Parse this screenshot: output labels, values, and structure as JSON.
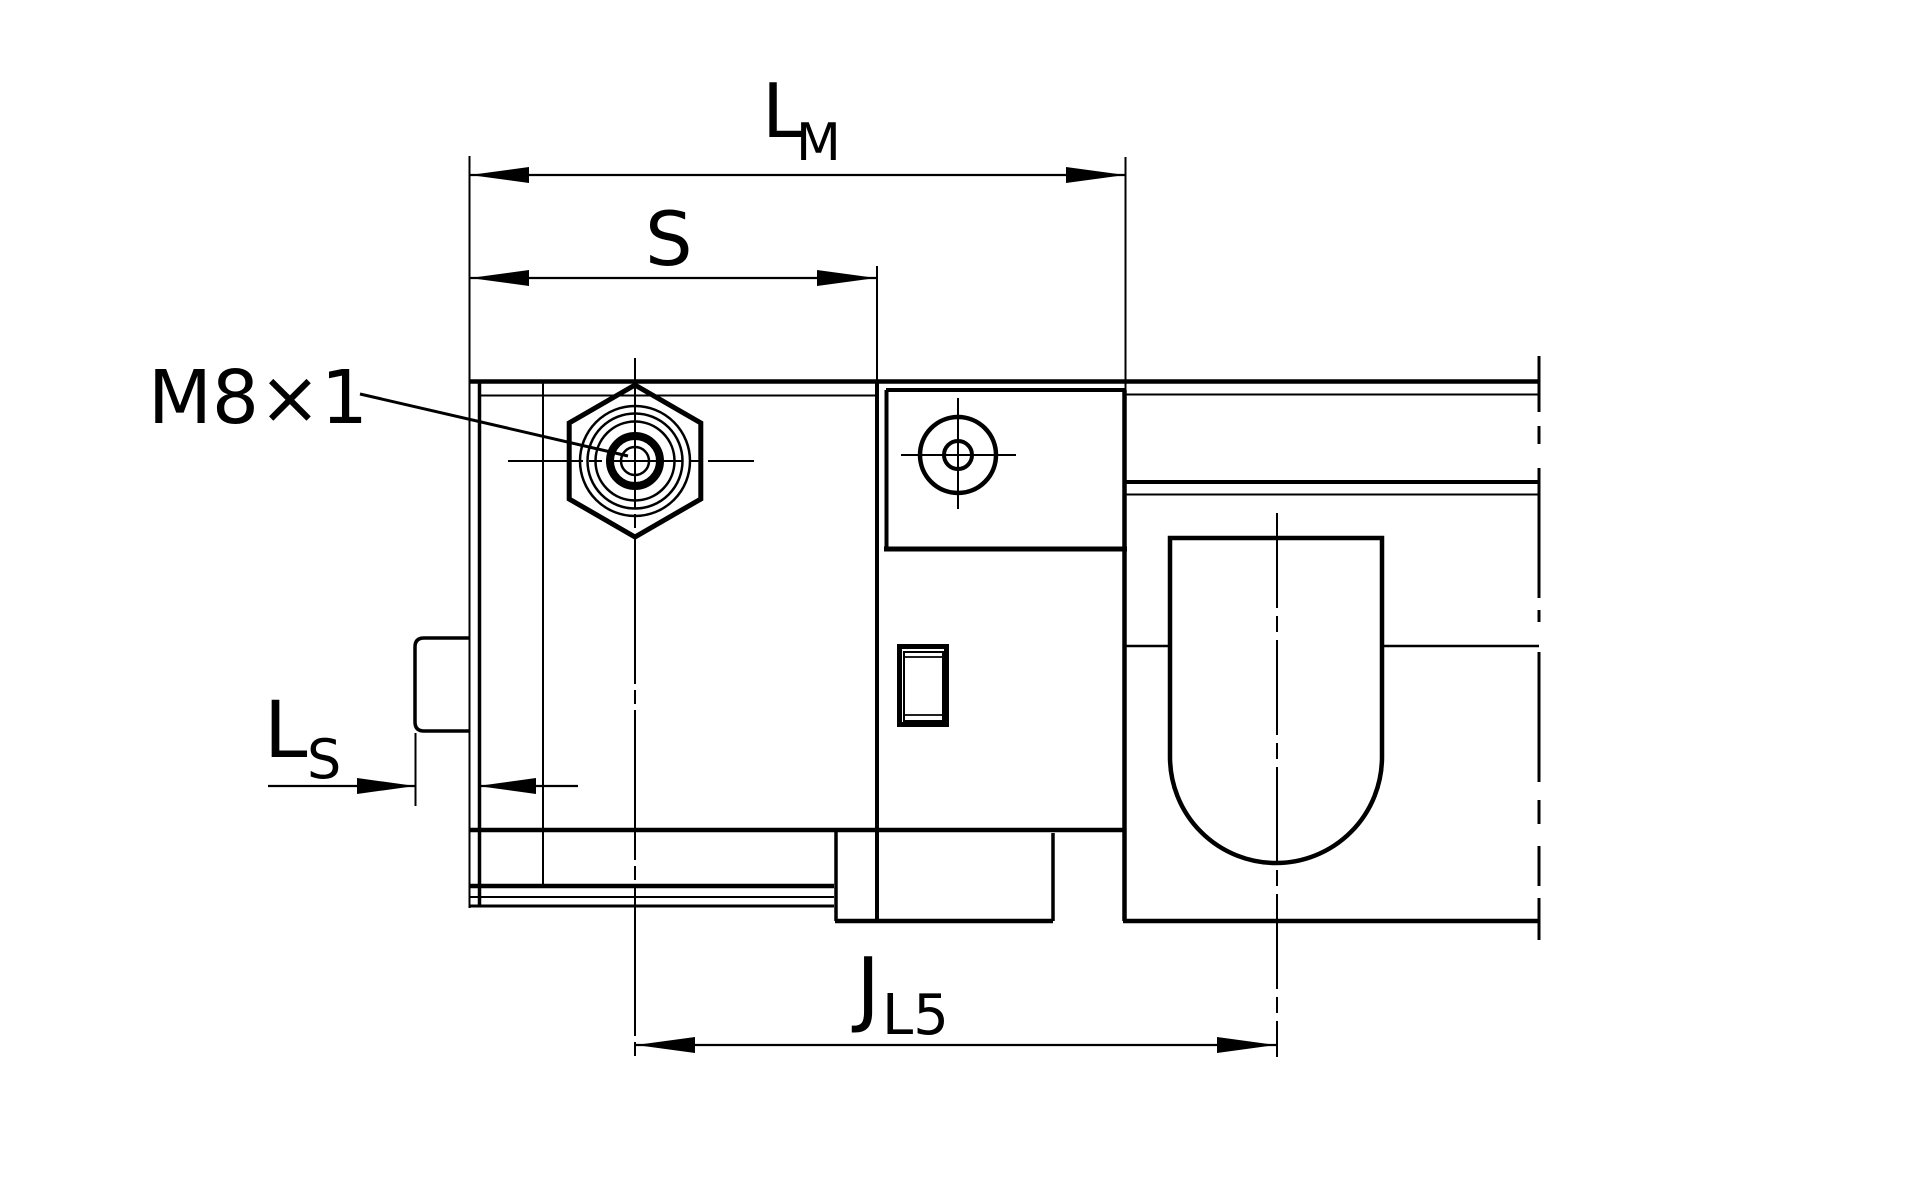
{
  "drawing": {
    "title_semantic": "linear-guide-side-view-dimension-drawing",
    "ink_color": "#000000",
    "background_color": "#ffffff",
    "labels": {
      "lm": {
        "main": "L",
        "sub": "M"
      },
      "s": {
        "main": "S"
      },
      "thread": {
        "text": "M8×1"
      },
      "ls": {
        "main": "L",
        "sub": "S"
      },
      "jl5": {
        "main": "J",
        "sub": "L5"
      }
    }
  }
}
